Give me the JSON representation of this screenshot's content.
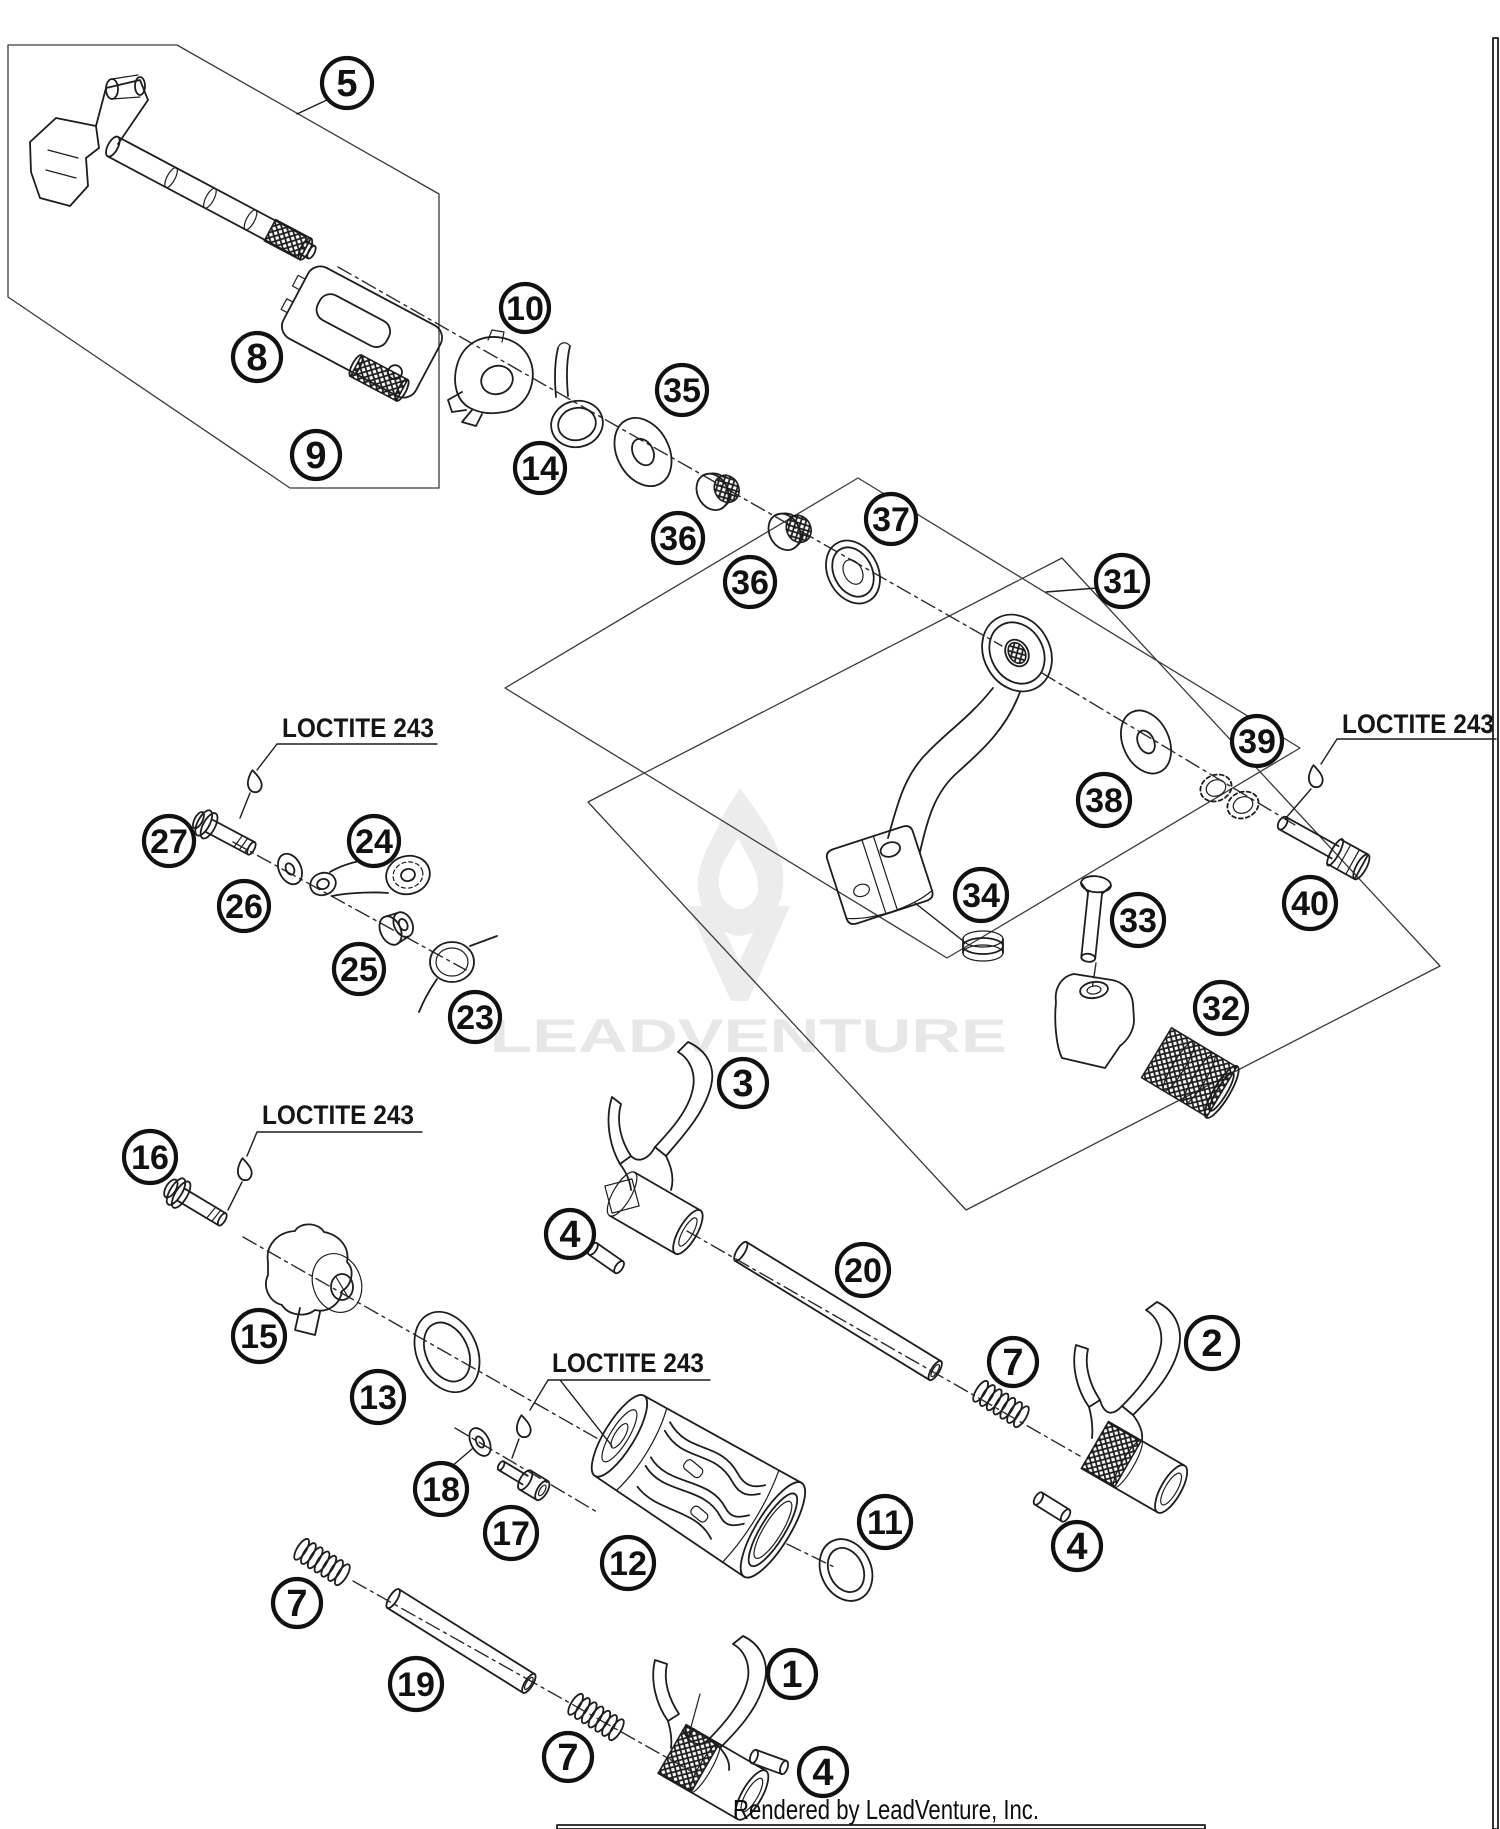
{
  "diagram": {
    "watermark": "LEADVENTURE",
    "footer": "Rendered by LeadVenture, Inc.",
    "callouts": [
      {
        "n": "5",
        "x": 347,
        "y": 83,
        "r": 25
      },
      {
        "n": "8",
        "x": 257,
        "y": 357,
        "r": 24
      },
      {
        "n": "9",
        "x": 316,
        "y": 455,
        "r": 24
      },
      {
        "n": "10",
        "x": 525,
        "y": 308,
        "r": 24
      },
      {
        "n": "14",
        "x": 540,
        "y": 468,
        "r": 25
      },
      {
        "n": "35",
        "x": 682,
        "y": 390,
        "r": 25
      },
      {
        "n": "36",
        "x": 678,
        "y": 538,
        "r": 25
      },
      {
        "n": "36",
        "x": 750,
        "y": 582,
        "r": 25
      },
      {
        "n": "37",
        "x": 891,
        "y": 519,
        "r": 25
      },
      {
        "n": "31",
        "x": 1122,
        "y": 581,
        "r": 26
      },
      {
        "n": "38",
        "x": 1104,
        "y": 800,
        "r": 26
      },
      {
        "n": "39",
        "x": 1257,
        "y": 741,
        "r": 25
      },
      {
        "n": "40",
        "x": 1310,
        "y": 903,
        "r": 26
      },
      {
        "n": "27",
        "x": 169,
        "y": 841,
        "r": 25
      },
      {
        "n": "26",
        "x": 244,
        "y": 906,
        "r": 25
      },
      {
        "n": "24",
        "x": 374,
        "y": 841,
        "r": 25
      },
      {
        "n": "25",
        "x": 359,
        "y": 969,
        "r": 25
      },
      {
        "n": "23",
        "x": 475,
        "y": 1017,
        "r": 25
      },
      {
        "n": "34",
        "x": 981,
        "y": 895,
        "r": 26
      },
      {
        "n": "33",
        "x": 1138,
        "y": 920,
        "r": 26
      },
      {
        "n": "32",
        "x": 1221,
        "y": 1008,
        "r": 26
      },
      {
        "n": "3",
        "x": 743,
        "y": 1083,
        "r": 24
      },
      {
        "n": "4",
        "x": 570,
        "y": 1234,
        "r": 24
      },
      {
        "n": "20",
        "x": 863,
        "y": 1270,
        "r": 26
      },
      {
        "n": "16",
        "x": 150,
        "y": 1157,
        "r": 26
      },
      {
        "n": "15",
        "x": 259,
        "y": 1336,
        "r": 26
      },
      {
        "n": "13",
        "x": 378,
        "y": 1397,
        "r": 26
      },
      {
        "n": "18",
        "x": 441,
        "y": 1489,
        "r": 26
      },
      {
        "n": "17",
        "x": 511,
        "y": 1533,
        "r": 26
      },
      {
        "n": "12",
        "x": 628,
        "y": 1563,
        "r": 26
      },
      {
        "n": "11",
        "x": 885,
        "y": 1522,
        "r": 26
      },
      {
        "n": "7",
        "x": 1013,
        "y": 1362,
        "r": 24
      },
      {
        "n": "2",
        "x": 1212,
        "y": 1343,
        "r": 26
      },
      {
        "n": "4",
        "x": 1077,
        "y": 1546,
        "r": 24
      },
      {
        "n": "7",
        "x": 297,
        "y": 1603,
        "r": 24
      },
      {
        "n": "19",
        "x": 416,
        "y": 1684,
        "r": 26
      },
      {
        "n": "7",
        "x": 568,
        "y": 1757,
        "r": 24
      },
      {
        "n": "1",
        "x": 792,
        "y": 1674,
        "r": 24
      },
      {
        "n": "4",
        "x": 823,
        "y": 1772,
        "r": 24
      }
    ],
    "loctite_labels": [
      {
        "text": "LOCTITE 243",
        "x": 282,
        "y": 737
      },
      {
        "text": "LOCTITE 243",
        "x": 1342,
        "y": 733
      },
      {
        "text": "LOCTITE 243",
        "x": 262,
        "y": 1124
      },
      {
        "text": "LOCTITE 243",
        "x": 552,
        "y": 1372
      }
    ]
  },
  "colors": {
    "line": "#1d1d1d",
    "watermark_text": "#e7e7e7",
    "pink_border": "#f0a6ad",
    "footer_bar": "#000000"
  }
}
